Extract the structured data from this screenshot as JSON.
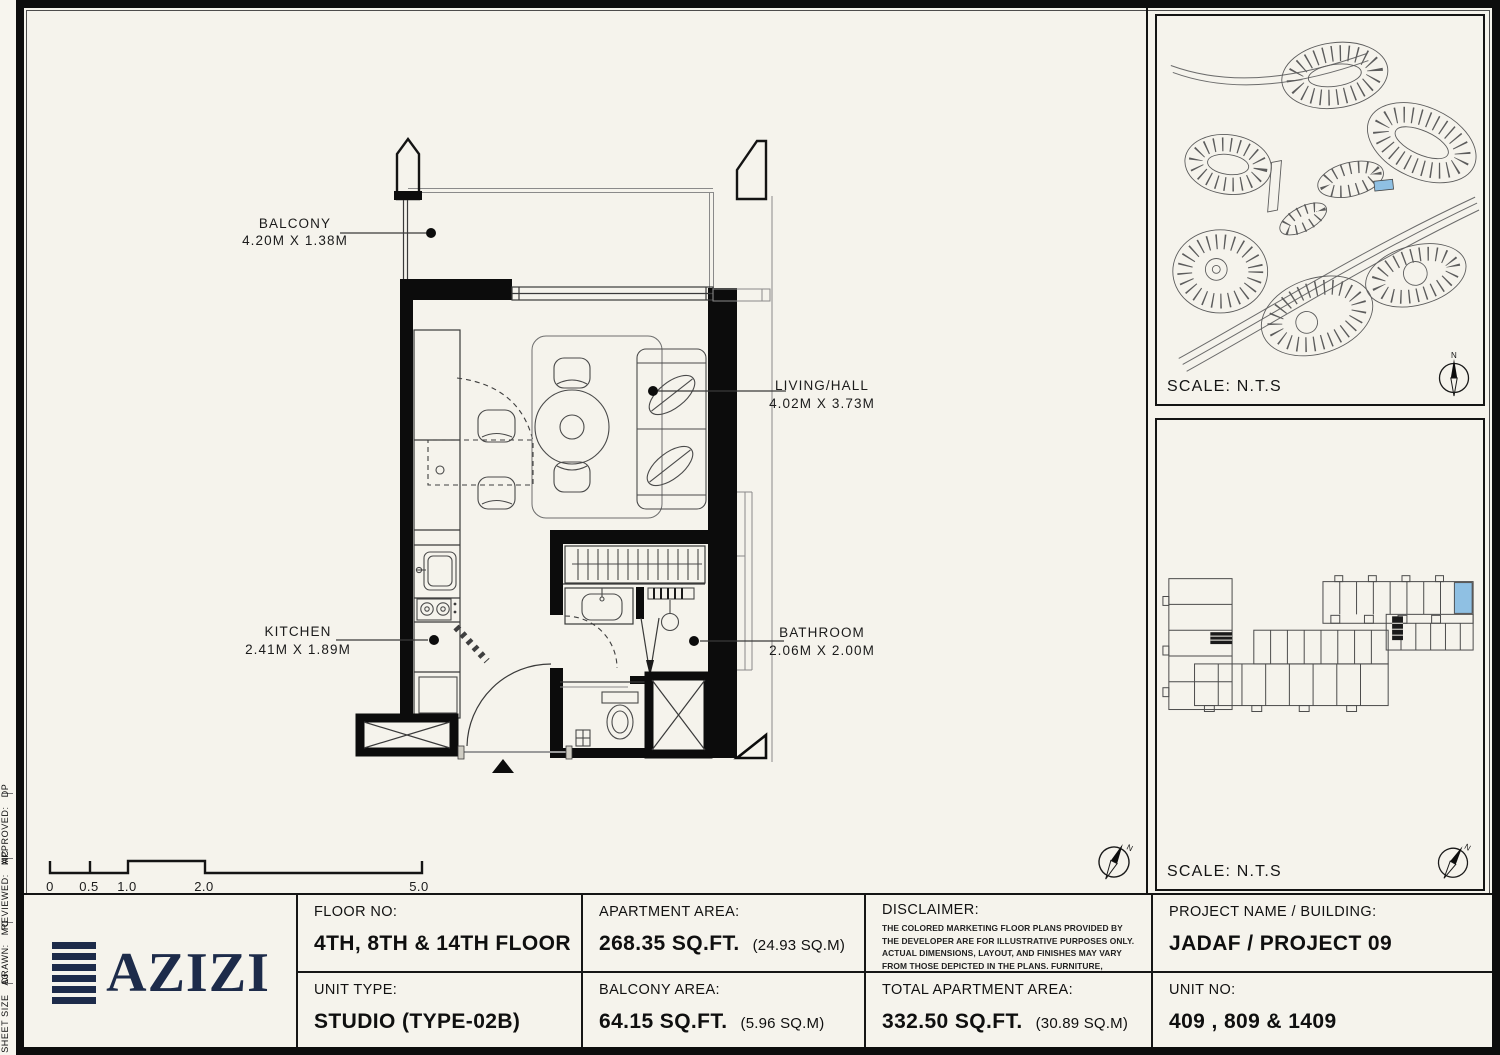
{
  "page": {
    "compass_n": "N",
    "paper_color": "#f5f3ec",
    "ink_color": "#0c0c0c",
    "navy_color": "#1d2b4a",
    "highlight_blue": "#8fc0e3"
  },
  "sidebar": {
    "items": [
      {
        "label": "APPROVED:",
        "value": "DP"
      },
      {
        "label": "REVIEWED:",
        "value": "MC"
      },
      {
        "label": "DRAWN:",
        "value": "MC"
      },
      {
        "label": "SHEET SIZE",
        "value": "A3"
      }
    ]
  },
  "plan": {
    "rooms": [
      {
        "name": "BALCONY",
        "dims": "4.20M X 1.38M"
      },
      {
        "name": "LIVING/HALL",
        "dims": "4.02M X 3.73M"
      },
      {
        "name": "KITCHEN",
        "dims": "2.41M X 1.89M"
      },
      {
        "name": "BATHROOM",
        "dims": "2.06M X 2.00M"
      }
    ],
    "scale_bar": {
      "labels": [
        "0",
        "0.5",
        "1.0",
        "2.0",
        "5.0"
      ]
    }
  },
  "site_map": {
    "scale_label": "SCALE: N.T.S"
  },
  "key_plan": {
    "scale_label": "SCALE: N.T.S"
  },
  "title_block": {
    "floor": {
      "label": "FLOOR NO:",
      "value": "4TH, 8TH & 14TH FLOOR"
    },
    "unit_type": {
      "label": "UNIT TYPE:",
      "value": "STUDIO (TYPE-02B)"
    },
    "apartment_area": {
      "label": "APARTMENT AREA:",
      "value": "268.35 SQ.FT.",
      "metric": "(24.93 SQ.M)"
    },
    "balcony_area": {
      "label": "BALCONY AREA:",
      "value": "64.15 SQ.FT.",
      "metric": "(5.96 SQ.M)"
    },
    "disclaimer": {
      "label": "DISCLAIMER:",
      "text": "THE COLORED MARKETING FLOOR PLANS PROVIDED BY THE DEVELOPER ARE FOR ILLUSTRATIVE PURPOSES ONLY. ACTUAL DIMENSIONS, LAYOUT, AND FINISHES MAY VARY FROM THOSE DEPICTED IN THE PLANS. FURNITURE, FIXTURES, AND EQUIPMENT SHOWN IN THE PLANS ARE FOR DECORATIVE PURPOSES ONLY AND ARE NOT INCLUDED IN THE PURCHASE OR LEASE OF THE PROPERTY. THE DEVELOPER RESERVES THE RIGHT TO MAKE MODIFICATIONS, REVISIONS, AND CHANGES TO THE FLOOR PLANS, SPECIFICATIONS, AND FEATURES WITHOUT PRIOR NOTICE."
    },
    "total_area": {
      "label": "TOTAL APARTMENT AREA:",
      "value": "332.50 SQ.FT.",
      "metric": "(30.89 SQ.M)"
    },
    "project": {
      "label": "PROJECT NAME / BUILDING:",
      "value": "JADAF / PROJECT 09"
    },
    "unit_no": {
      "label": "UNIT NO:",
      "value": "409 , 809 & 1409"
    }
  },
  "logo": {
    "text": "AZIZI"
  }
}
